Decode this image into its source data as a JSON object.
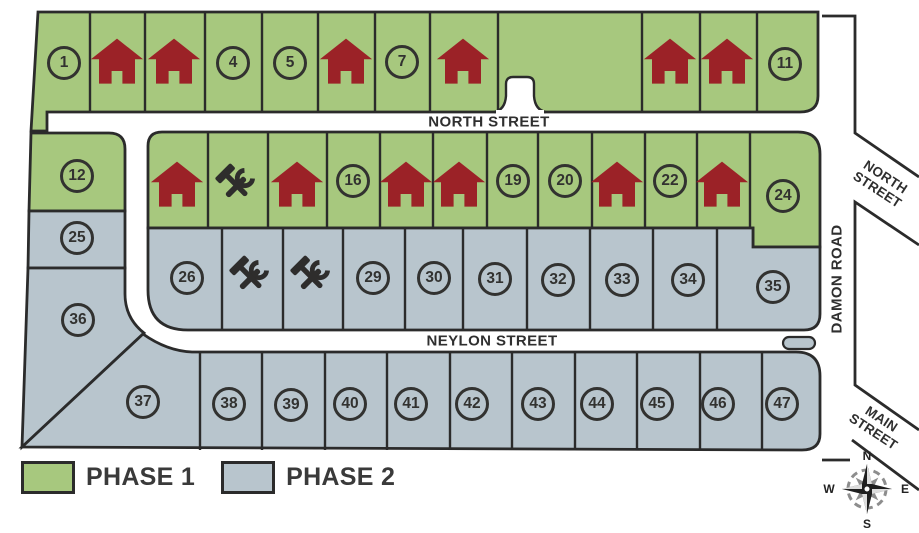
{
  "map": {
    "streets": {
      "north_street": "NORTH STREET",
      "north_street_right": "NORTH STREET",
      "neylon_street": "NEYLON STREET",
      "damon_road": "DAMON ROAD",
      "main_street": "MAIN STREET"
    },
    "lot_numbers": {
      "1": "1",
      "4": "4",
      "5": "5",
      "7": "7",
      "11": "11",
      "12": "12",
      "16": "16",
      "19": "19",
      "20": "20",
      "22": "22",
      "24": "24",
      "25": "25",
      "26": "26",
      "29": "29",
      "30": "30",
      "31": "31",
      "32": "32",
      "33": "33",
      "34": "34",
      "35": "35",
      "36": "36",
      "37": "37",
      "38": "38",
      "39": "39",
      "40": "40",
      "41": "41",
      "42": "42",
      "43": "43",
      "44": "44",
      "45": "45",
      "46": "46",
      "47": "47"
    },
    "house_lots": [
      2,
      3,
      6,
      8,
      9,
      10,
      13,
      15,
      17,
      18,
      21,
      23
    ],
    "construction_lots": [
      14,
      27,
      28
    ],
    "phase1_lots": [
      1,
      2,
      3,
      4,
      5,
      6,
      7,
      8,
      9,
      10,
      11,
      12,
      13,
      14,
      15,
      16,
      17,
      18,
      19,
      20,
      21,
      22,
      23,
      24
    ],
    "phase2_lots": [
      25,
      26,
      27,
      28,
      29,
      30,
      31,
      32,
      33,
      34,
      35,
      36,
      37,
      38,
      39,
      40,
      41,
      42,
      43,
      44,
      45,
      46,
      47
    ],
    "colors": {
      "phase1": "#a7c87e",
      "phase2": "#b8c5cd",
      "house": "#9b2227",
      "construction": "#2e2d2c",
      "outline": "#2b2b2b",
      "road": "#ffffff"
    }
  },
  "legend": {
    "items": [
      {
        "label": "PHASE 1",
        "color": "#a7c87e"
      },
      {
        "label": "PHASE 2",
        "color": "#b8c5cd"
      }
    ]
  },
  "compass": {
    "n": "N",
    "e": "E",
    "s": "S",
    "w": "W"
  }
}
